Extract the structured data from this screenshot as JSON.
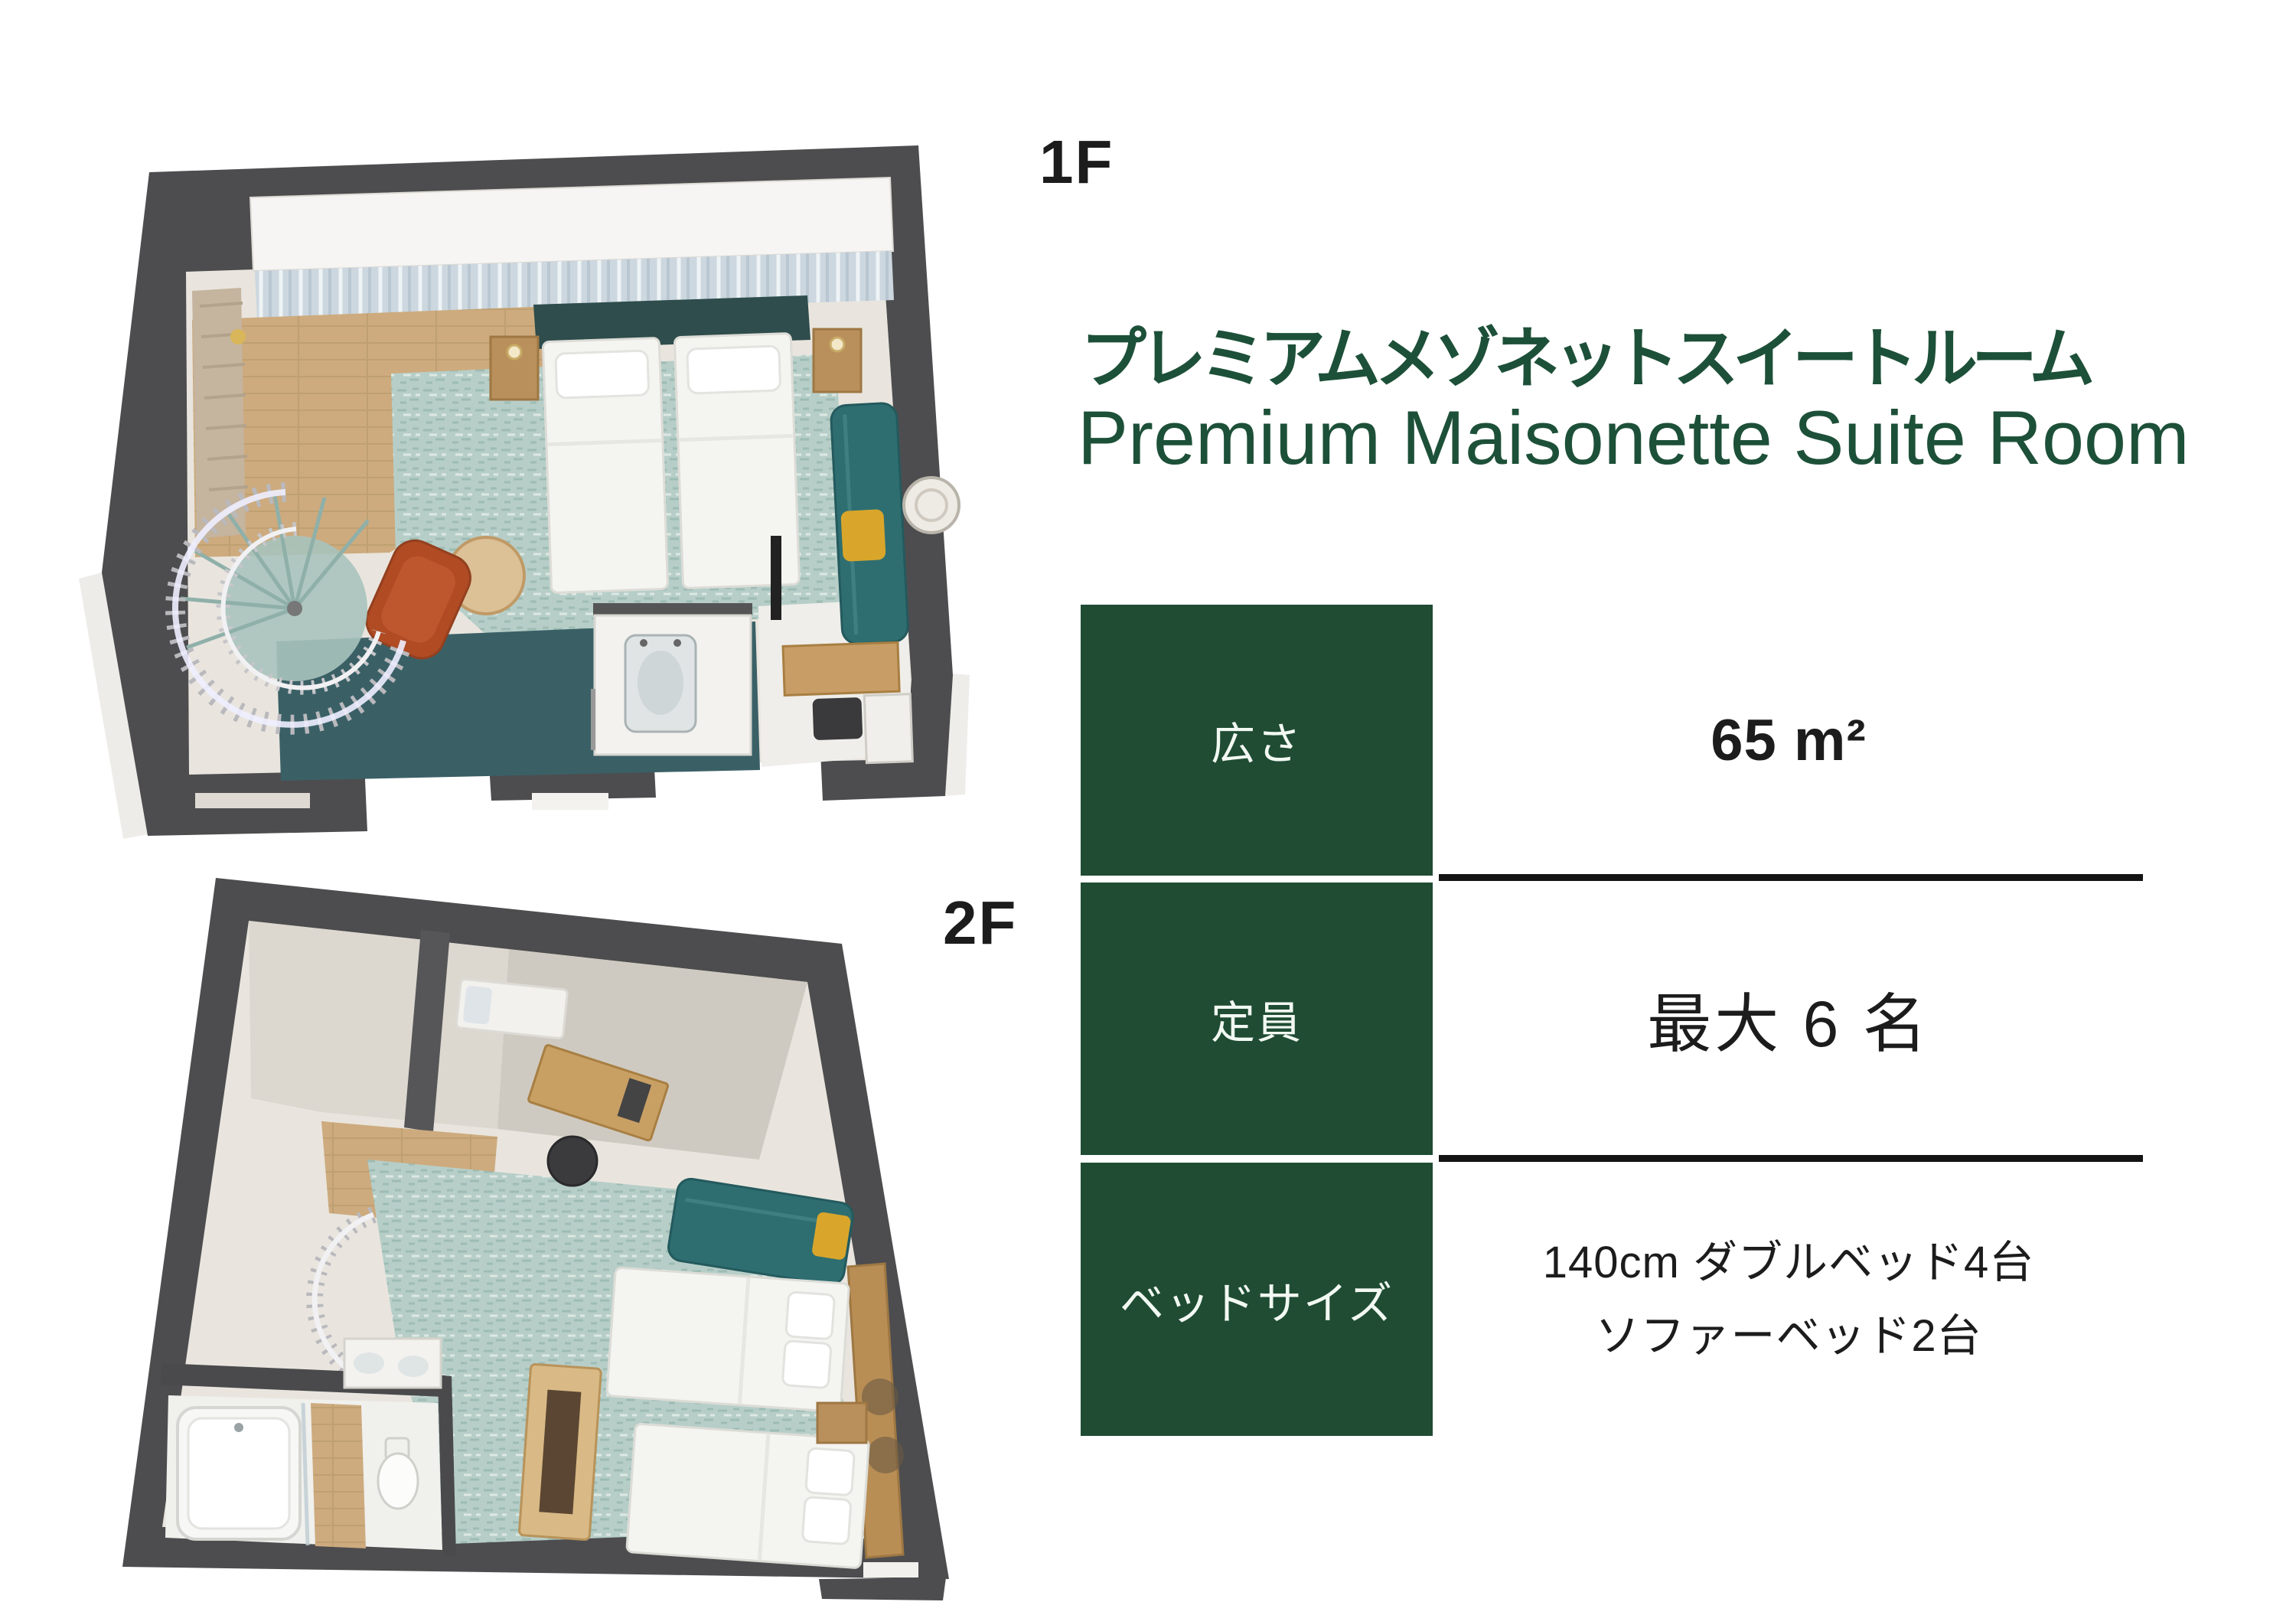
{
  "floor_plans": [
    {
      "label": "1F"
    },
    {
      "label": "2F"
    }
  ],
  "title": {
    "ja": "プレミアムメゾネットスイートルーム",
    "en": "Premium Maisonette Suite Room"
  },
  "spec_table": {
    "rows": [
      {
        "label": "広さ",
        "value_lines": [
          "65 m²"
        ]
      },
      {
        "label": "定員",
        "value_lines": [
          "最大 6 名"
        ]
      },
      {
        "label": "ベッドサイズ",
        "value_lines": [
          "140cm ダブルベッド4台",
          "ソファーベッド2台"
        ]
      }
    ]
  },
  "colors": {
    "background": "#ffffff",
    "title_green": "#1d5038",
    "cell_green": "#1f4c33",
    "cell_text": "#f2f8f2",
    "text_black": "#1c1c1c",
    "divider": "#141414",
    "wall_gray": "#4d4d4f",
    "rug_teal_light": "#b7cec8",
    "carpet_teal_dark": "#3a6066",
    "sofa_teal": "#2e6e71",
    "wood": "#cdab7e",
    "accent_orange": "#b04b24",
    "accent_mustard": "#d9a62b"
  }
}
